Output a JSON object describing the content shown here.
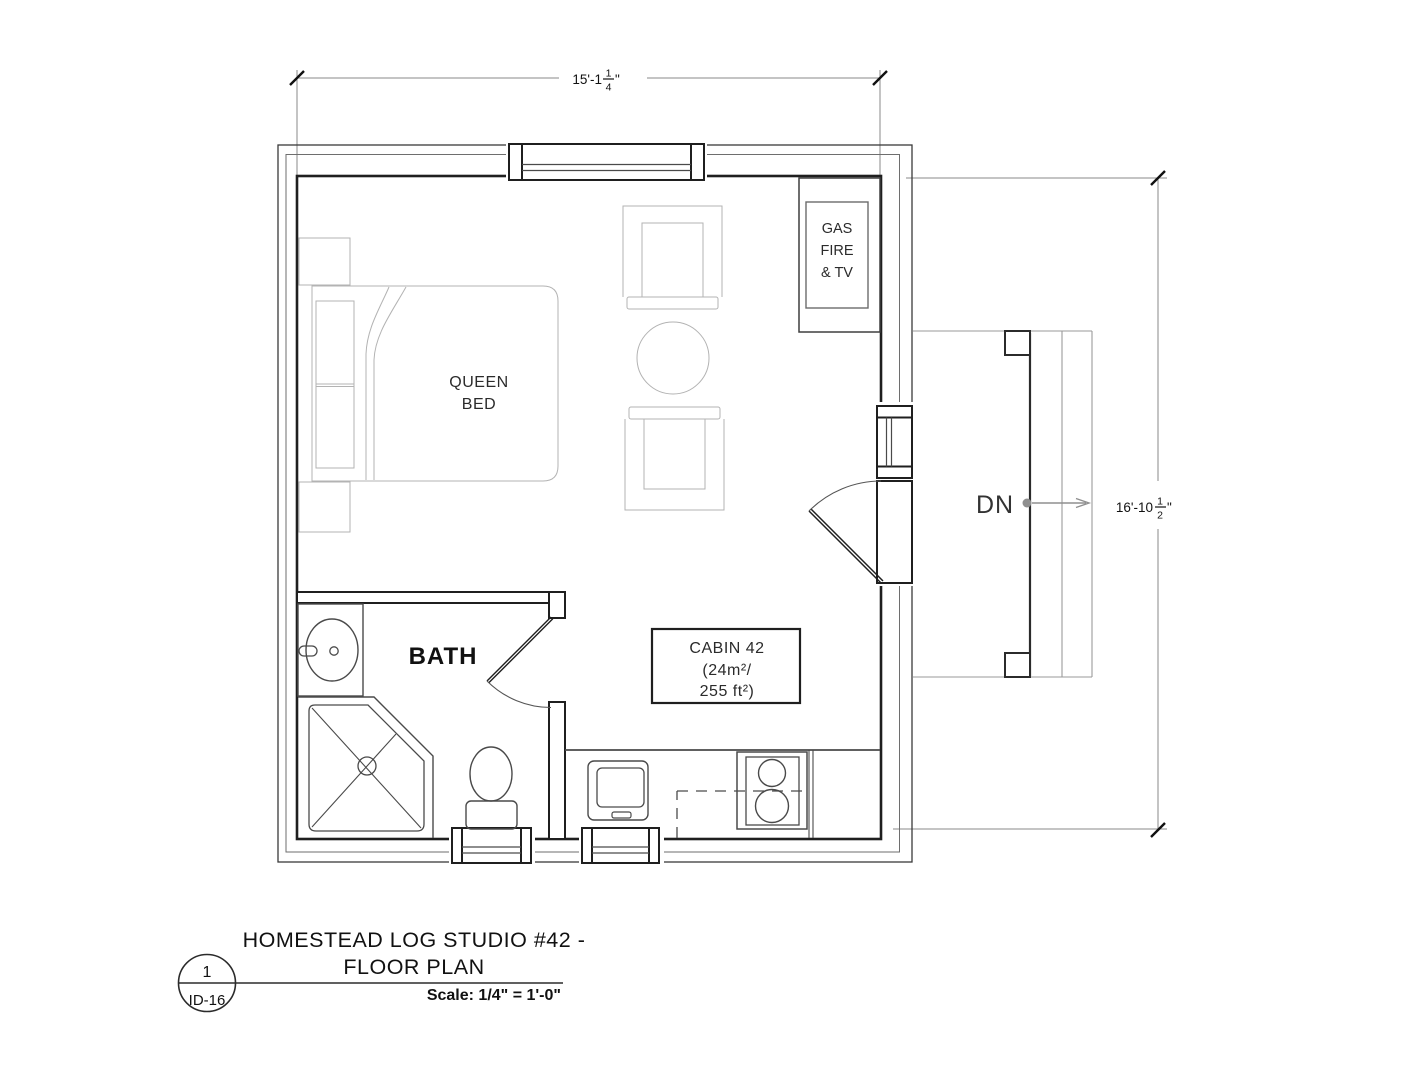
{
  "page": {
    "background": "#ffffff"
  },
  "plan": {
    "room_labels": {
      "bed": {
        "line1": "QUEEN",
        "line2": "BED"
      },
      "gas_fire": {
        "line1": "GAS",
        "line2": "FIRE",
        "line3": "& TV"
      },
      "bath": "BATH",
      "cabin": {
        "line1": "CABIN 42",
        "line2": "(24m²/",
        "line3": "255 ft²)"
      },
      "stairs_down": "DN"
    },
    "dimensions": {
      "top_width": {
        "main": "15'-1",
        "fraction_numerator": "1",
        "fraction_denominator": "4",
        "unit_suffix": "\""
      },
      "right_height": {
        "main": "16'-10",
        "fraction_numerator": "1",
        "fraction_denominator": "2",
        "unit_suffix": "\""
      }
    }
  },
  "title_block": {
    "drawing_number": "1",
    "sheet_id": "ID-16",
    "title_line1": "HOMESTEAD LOG STUDIO #42 -",
    "title_line2": "FLOOR PLAN",
    "scale_label": "Scale: 1/4\" = 1'-0\""
  },
  "colors": {
    "wall_line": "#1f1f1f",
    "fixture_line": "#4a4a4a",
    "furniture_line": "#b3b3b3",
    "dimension_line": "#8a8a8a",
    "text_dark": "#111111"
  }
}
